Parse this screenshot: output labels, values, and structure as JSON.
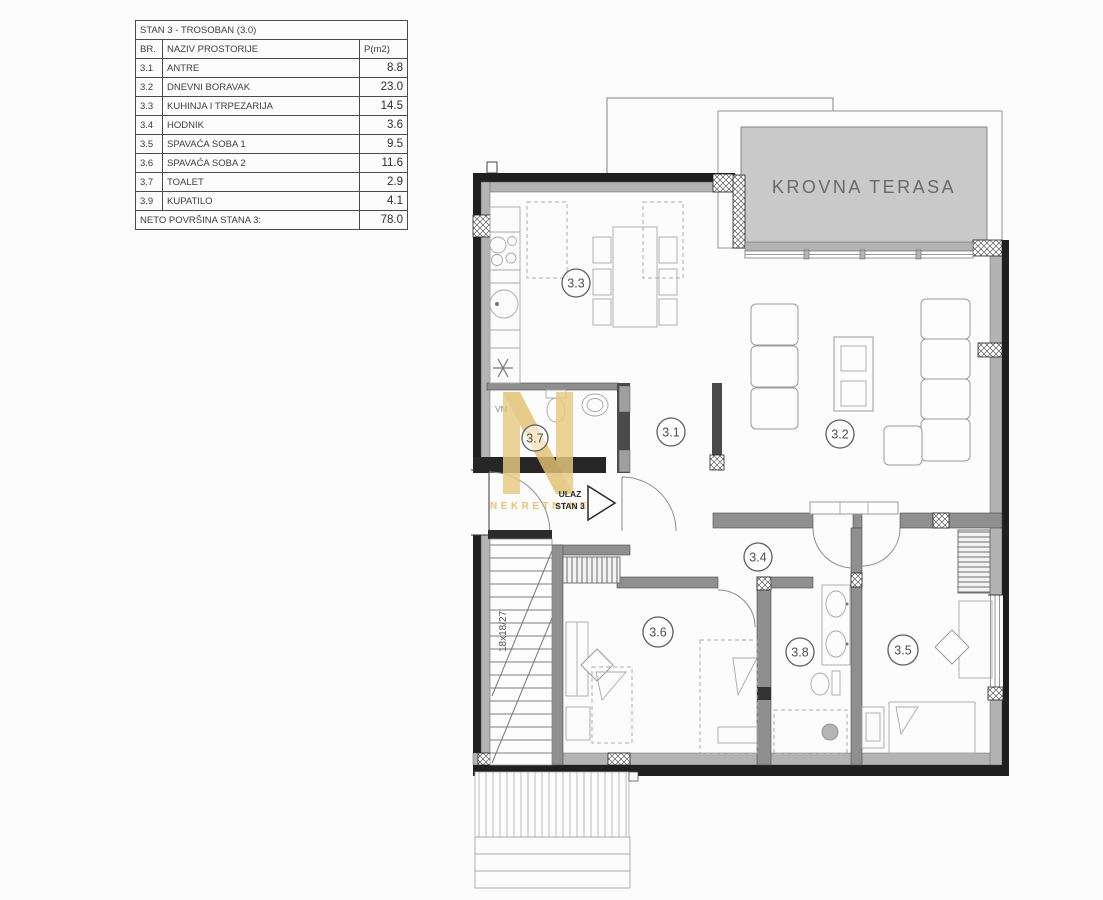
{
  "table": {
    "title": "STAN 3 - TROSOBAN (3.0)",
    "header": {
      "br": "BR.",
      "name": "NAZIV PROSTORIJE",
      "area": "P(m2)"
    },
    "rows": [
      {
        "br": "3.1",
        "name": "ANTRE",
        "area": "8.8"
      },
      {
        "br": "3.2",
        "name": "DNEVNI BORAVAK",
        "area": "23.0"
      },
      {
        "br": "3.3",
        "name": "KUHINJA I TRPEZARIJA",
        "area": "14.5"
      },
      {
        "br": "3.4",
        "name": "HODNIK",
        "area": "3.6"
      },
      {
        "br": "3.5",
        "name": "SPAVAĆA SOBA 1",
        "area": "9.5"
      },
      {
        "br": "3.6",
        "name": "SPAVAĆA SOBA 2",
        "area": "11.6"
      },
      {
        "br": "3.7",
        "name": "TOALET",
        "area": "2.9"
      },
      {
        "br": "3.9",
        "name": "KUPATILO",
        "area": "4.1"
      }
    ],
    "total": {
      "label": "NETO POVRŠINA STANA 3:",
      "value": "78.0"
    }
  },
  "plan": {
    "terrace_label": "KROVNA TERASA",
    "entrance": {
      "line1": "ULAZ",
      "line2": "STAN 3"
    },
    "stairs_label": "18x18/27",
    "vm_label": "VM",
    "room_labels": [
      "3.3",
      "3.1",
      "3.2",
      "3.7",
      "3.4",
      "3.6",
      "3.8",
      "3.5"
    ],
    "watermark": {
      "text": "NEKRETNINE",
      "color": "#e3bd66"
    },
    "colors": {
      "wall_dark": "#1f1f1f",
      "wall_gray": "#b3b3b3",
      "interior_wall": "#8f8f8f",
      "terrace_fill": "#c9c9c9",
      "terrace_text": "#6a6a6a",
      "line": "#9a9a9a"
    }
  }
}
